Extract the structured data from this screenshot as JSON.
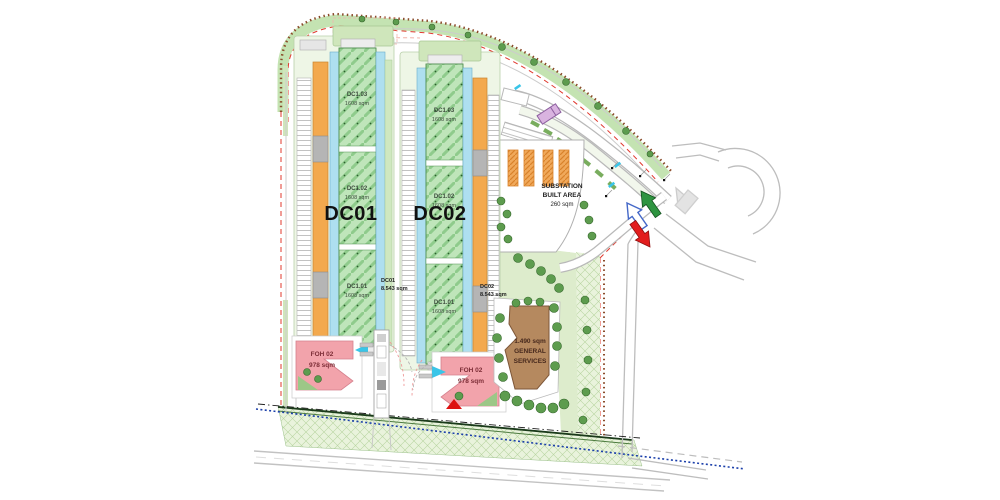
{
  "plan": {
    "dc01": {
      "big_label": "DC01",
      "area_line1": "DC01",
      "area_line2": "8.543 sqm",
      "halls": [
        {
          "name": "DC1.03",
          "area": "1608 sqm"
        },
        {
          "name": "DC1.02",
          "area": "1608 sqm"
        },
        {
          "name": "DC1.01",
          "area": "1608 sqm"
        }
      ]
    },
    "dc02": {
      "big_label": "DC02",
      "area_line1": "DC02",
      "area_line2": "8.543 sqm",
      "halls": [
        {
          "name": "DC1.03",
          "area": "1608 sqm"
        },
        {
          "name": "DC1.02",
          "area": "1608 sqm"
        },
        {
          "name": "DC1.01",
          "area": "1608 sqm"
        }
      ]
    },
    "foh_left": {
      "name": "FOH 02",
      "area": "978 sqm"
    },
    "foh_right": {
      "name": "FOH 02",
      "area": "978 sqm"
    },
    "substation": {
      "line1": "SUBSTATION",
      "line2": "BUILT AREA",
      "line3": "260 sqm"
    },
    "general_services": {
      "line1": "1.490 sqm",
      "line2": "GENERAL",
      "line3": "SERVICES"
    }
  },
  "colors": {
    "hall_green": "#bfe5ba",
    "plant_orange": "#f3a94e",
    "corridor_blue": "#aedff0",
    "foh_pink": "#f2a3ab",
    "services_brown": "#b5895f",
    "buffer_green": "#e9f3dc",
    "tree_green": "#5d9c4e",
    "boundary_red": "#e0392e",
    "entry_arrow_green": "#2e9440",
    "exit_arrow_red": "#e21d1d",
    "two_way_arrow_blue": "#4468c8",
    "utility_line_blue": "#1b3faa"
  }
}
